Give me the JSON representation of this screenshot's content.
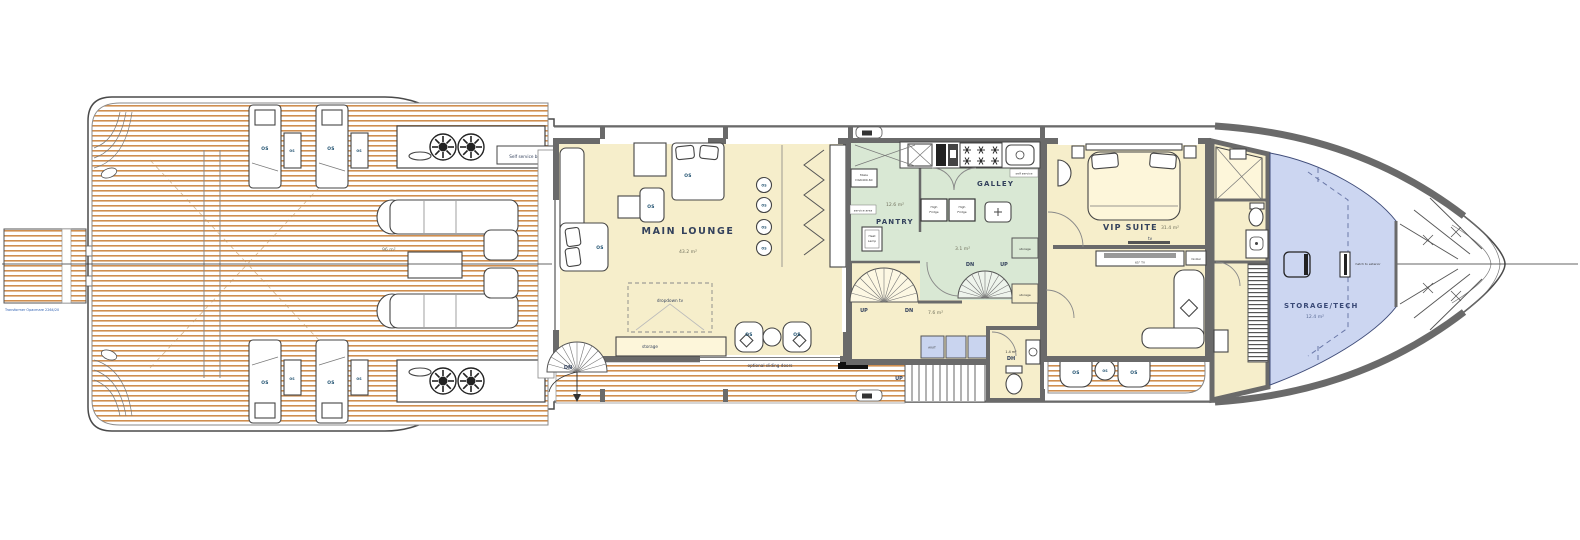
{
  "colors": {
    "teak_stripe": "#cf8e4f",
    "interior_cream": "#f6eecb",
    "galley_green": "#d9e8d4",
    "tech_lavender": "#ccd6f1",
    "cabinet_blue": "#c9d4ef",
    "wall_gray": "#6a6a6a",
    "label_navy": "#33415c",
    "os_blue": "#1d4f6e"
  },
  "labels": {
    "os": "OS",
    "up": "UP",
    "dn": "DN",
    "storage": "storage"
  },
  "platform": {
    "transformer": "Transformer Opacmare 2264/20"
  },
  "aft_deck": {
    "area": "96 m²",
    "self_service_bar": "Self service bar"
  },
  "lounge": {
    "name": "MAIN LOUNGE",
    "area": "43.2 m²",
    "dropdown_tv": "dropdown tv",
    "optional_sliding_doors": "optional sliding doors"
  },
  "pantry": {
    "name": "PANTRY",
    "area": "12.6 m²",
    "miele_line1": "Miele",
    "miele_line2": "DG6400-60",
    "heat_line1": "Heat",
    "heat_line2": "Lamp",
    "service_area": "service area"
  },
  "galley": {
    "name": "GALLEY",
    "fridge_line1": "High",
    "fridge_line2": "Fridge",
    "self_service": "self service"
  },
  "stairs": {
    "landing_area": "3.1 m²",
    "corridor_area": "7.6 m²"
  },
  "corridor": {
    "av_it": "AV/IT"
  },
  "day_head": {
    "name": "DH",
    "area": "1.4 m²"
  },
  "vip": {
    "name": "VIP SUITE",
    "area": "31.4 m²",
    "tv": "tv",
    "tv_cabinet": "65\" TV",
    "minibar": "minibar"
  },
  "storage_tech": {
    "name": "STORAGE/TECH",
    "area": "12.4 m²",
    "hatch_to_exterior": "hatch to exterior"
  }
}
